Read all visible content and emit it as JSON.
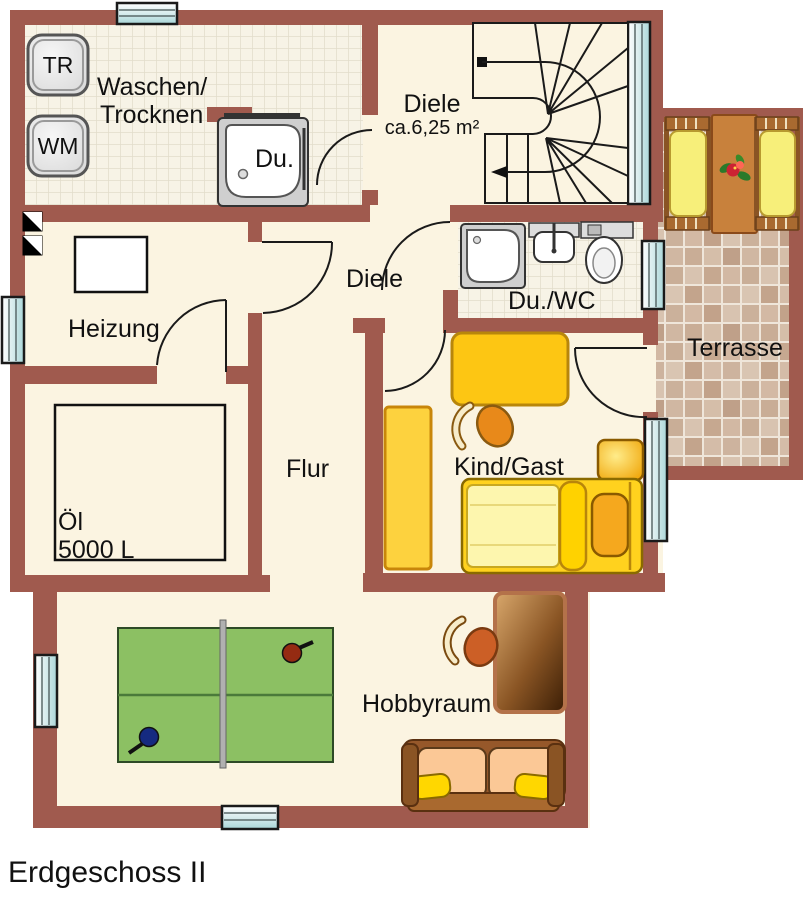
{
  "title": "Erdgeschoss II",
  "colors": {
    "wall": "#a05a4e",
    "floor": "#fbf4e1",
    "tiled_floor": "#f7f3e6",
    "terrace_tile": "#cdb39e",
    "window_glass": "#cfe9ea",
    "furniture_yellow": "#fdc613",
    "bed_yellow": "#ffd21e",
    "table_tennis_green": "#8cc063",
    "wood_brown": "#96582a",
    "outline": "#1a1a1a"
  },
  "rooms": {
    "waschen_trocknen": {
      "label_line1": "Waschen/",
      "label_line2": "Trocknen"
    },
    "diele_upper": {
      "label": "Diele",
      "area": "ca.6,25 m²"
    },
    "dusche": {
      "label": "Du."
    },
    "heizung": {
      "label": "Heizung"
    },
    "diele_lower": {
      "label": "Diele"
    },
    "du_wc": {
      "label": "Du./WC"
    },
    "terrasse": {
      "label": "Terrasse"
    },
    "kind_gast": {
      "label": "Kind/Gast"
    },
    "flur": {
      "label": "Flur"
    },
    "oel_tank": {
      "label": "Öl",
      "capacity": "5000 L"
    },
    "hobbyraum": {
      "label": "Hobbyraum"
    }
  },
  "appliances": {
    "dryer_label": "TR",
    "washer_label": "WM"
  }
}
